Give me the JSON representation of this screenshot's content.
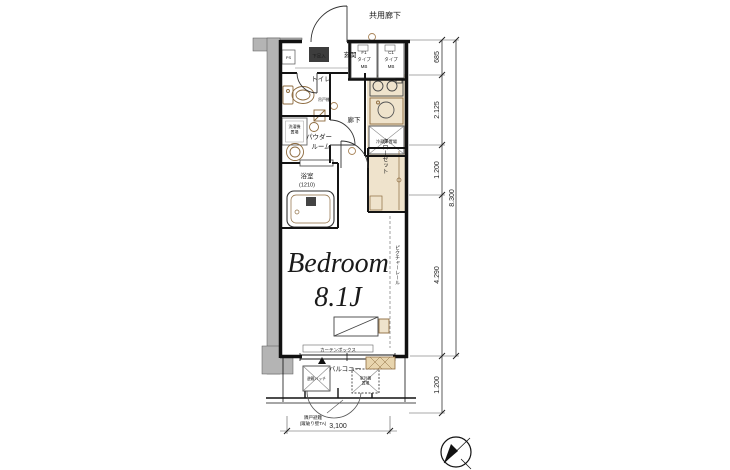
{
  "header": {
    "corridor": "共用廊下"
  },
  "rooms": {
    "entrance": "玄関",
    "shoe": "下足入",
    "ps": "PS",
    "toilet": "トイレ",
    "cabinet": "吊戸棚",
    "hall": "廊下",
    "powder1": "パウダー",
    "powder2": "ルーム",
    "washer1": "洗濯機",
    "washer2": "置場",
    "bath1": "浴室",
    "bath2": "(1210)",
    "closet": "クローゼット",
    "fridge": "冷蔵庫置場",
    "bedroom_name": "Bedroom",
    "bedroom_size": "8.1J"
  },
  "features": {
    "picture_rail": "ピクチャーレール",
    "curtain_box": "カーテンボックス",
    "balcony": "バルコニー",
    "hatch": "避難ハッチ",
    "outdoor1": "室外機",
    "outdoor2": "置場",
    "mb1": {
      "l1": "F1",
      "l2": "タイプ",
      "l3": "MB"
    },
    "mb2": {
      "l1": "C1",
      "l2": "タイプ",
      "l3": "MB"
    }
  },
  "annotations": {
    "evac1": "隣戸避難",
    "evac2": "(蹴破り壁TA)"
  },
  "dimensions": {
    "right": [
      "685",
      "2.125",
      "1.200",
      "4.290",
      "1.200"
    ],
    "total": "8.300",
    "bottom": "3,100"
  },
  "colors": {
    "wall_gray": "#b4b4b4",
    "beige": "#efe3cc",
    "fixture_brown": "#8d6b3f",
    "line": "#1a1a1a",
    "background": "#ffffff"
  }
}
